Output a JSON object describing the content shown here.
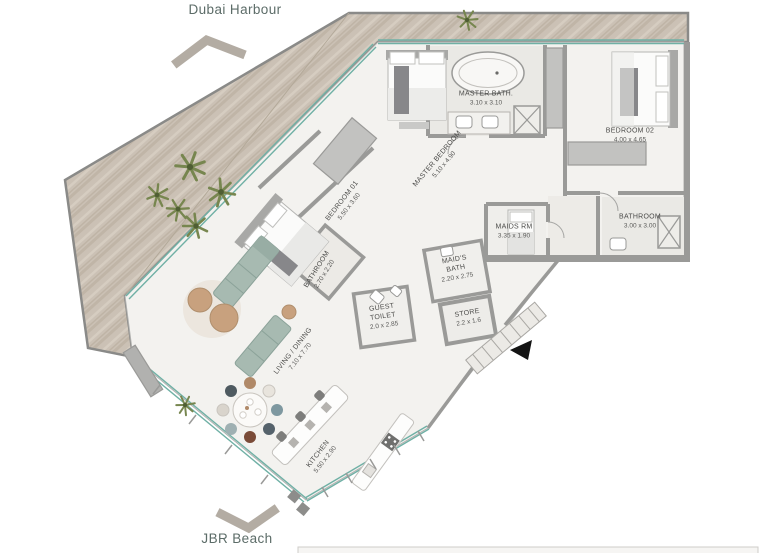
{
  "nav": {
    "top": "Dubai Harbour",
    "bottom": "JBR Beach"
  },
  "rooms": [
    {
      "name": "MASTER BATH.",
      "dims": "3.10 x 3.10"
    },
    {
      "name": "BEDROOM 02",
      "dims": "4.00 x 4.65"
    },
    {
      "name": "MASTER BEDROOM",
      "dims": "5.10 x 4.90"
    },
    {
      "name": "BEDROOM 01",
      "dims": "5.50 x 3.60"
    },
    {
      "name": "MAIDS RM",
      "dims": "3.35 x 1.90"
    },
    {
      "name": "BATHROOM",
      "dims": "3.00 x 3.00"
    },
    {
      "name": "BATHROOM",
      "dims": "2.70 x 2.20"
    },
    {
      "name": "MAID'S BATH",
      "dims": "2.20 x 2.75"
    },
    {
      "name": "GUEST TOILET",
      "dims": "2.0 x 2.85"
    },
    {
      "name": "STORE",
      "dims": "2.2 x 1.6"
    },
    {
      "name": "LIVING / DINING",
      "dims": "7.10 x 7.70"
    },
    {
      "name": "KITCHEN",
      "dims": "5.50 x 2.90"
    }
  ],
  "icons": {
    "top_direction": "chevron-up-icon",
    "bottom_direction": "chevron-down-icon",
    "entry": "entry-arrow-icon"
  },
  "colors": {
    "deck_wood": "#cbc1b5",
    "floor": "#f3f2ef",
    "bath_floor": "#eae9e5",
    "wall": "#9a9a98",
    "glass": "#6fb0a5",
    "plant": "#77864f",
    "sofa": "#a7bab1",
    "pouf": "#c8a17e",
    "label_text": "#4c4c4a",
    "nav_text": "#5c6c68",
    "chevron": "#b3aca3",
    "entry_arrow": "#141414"
  }
}
